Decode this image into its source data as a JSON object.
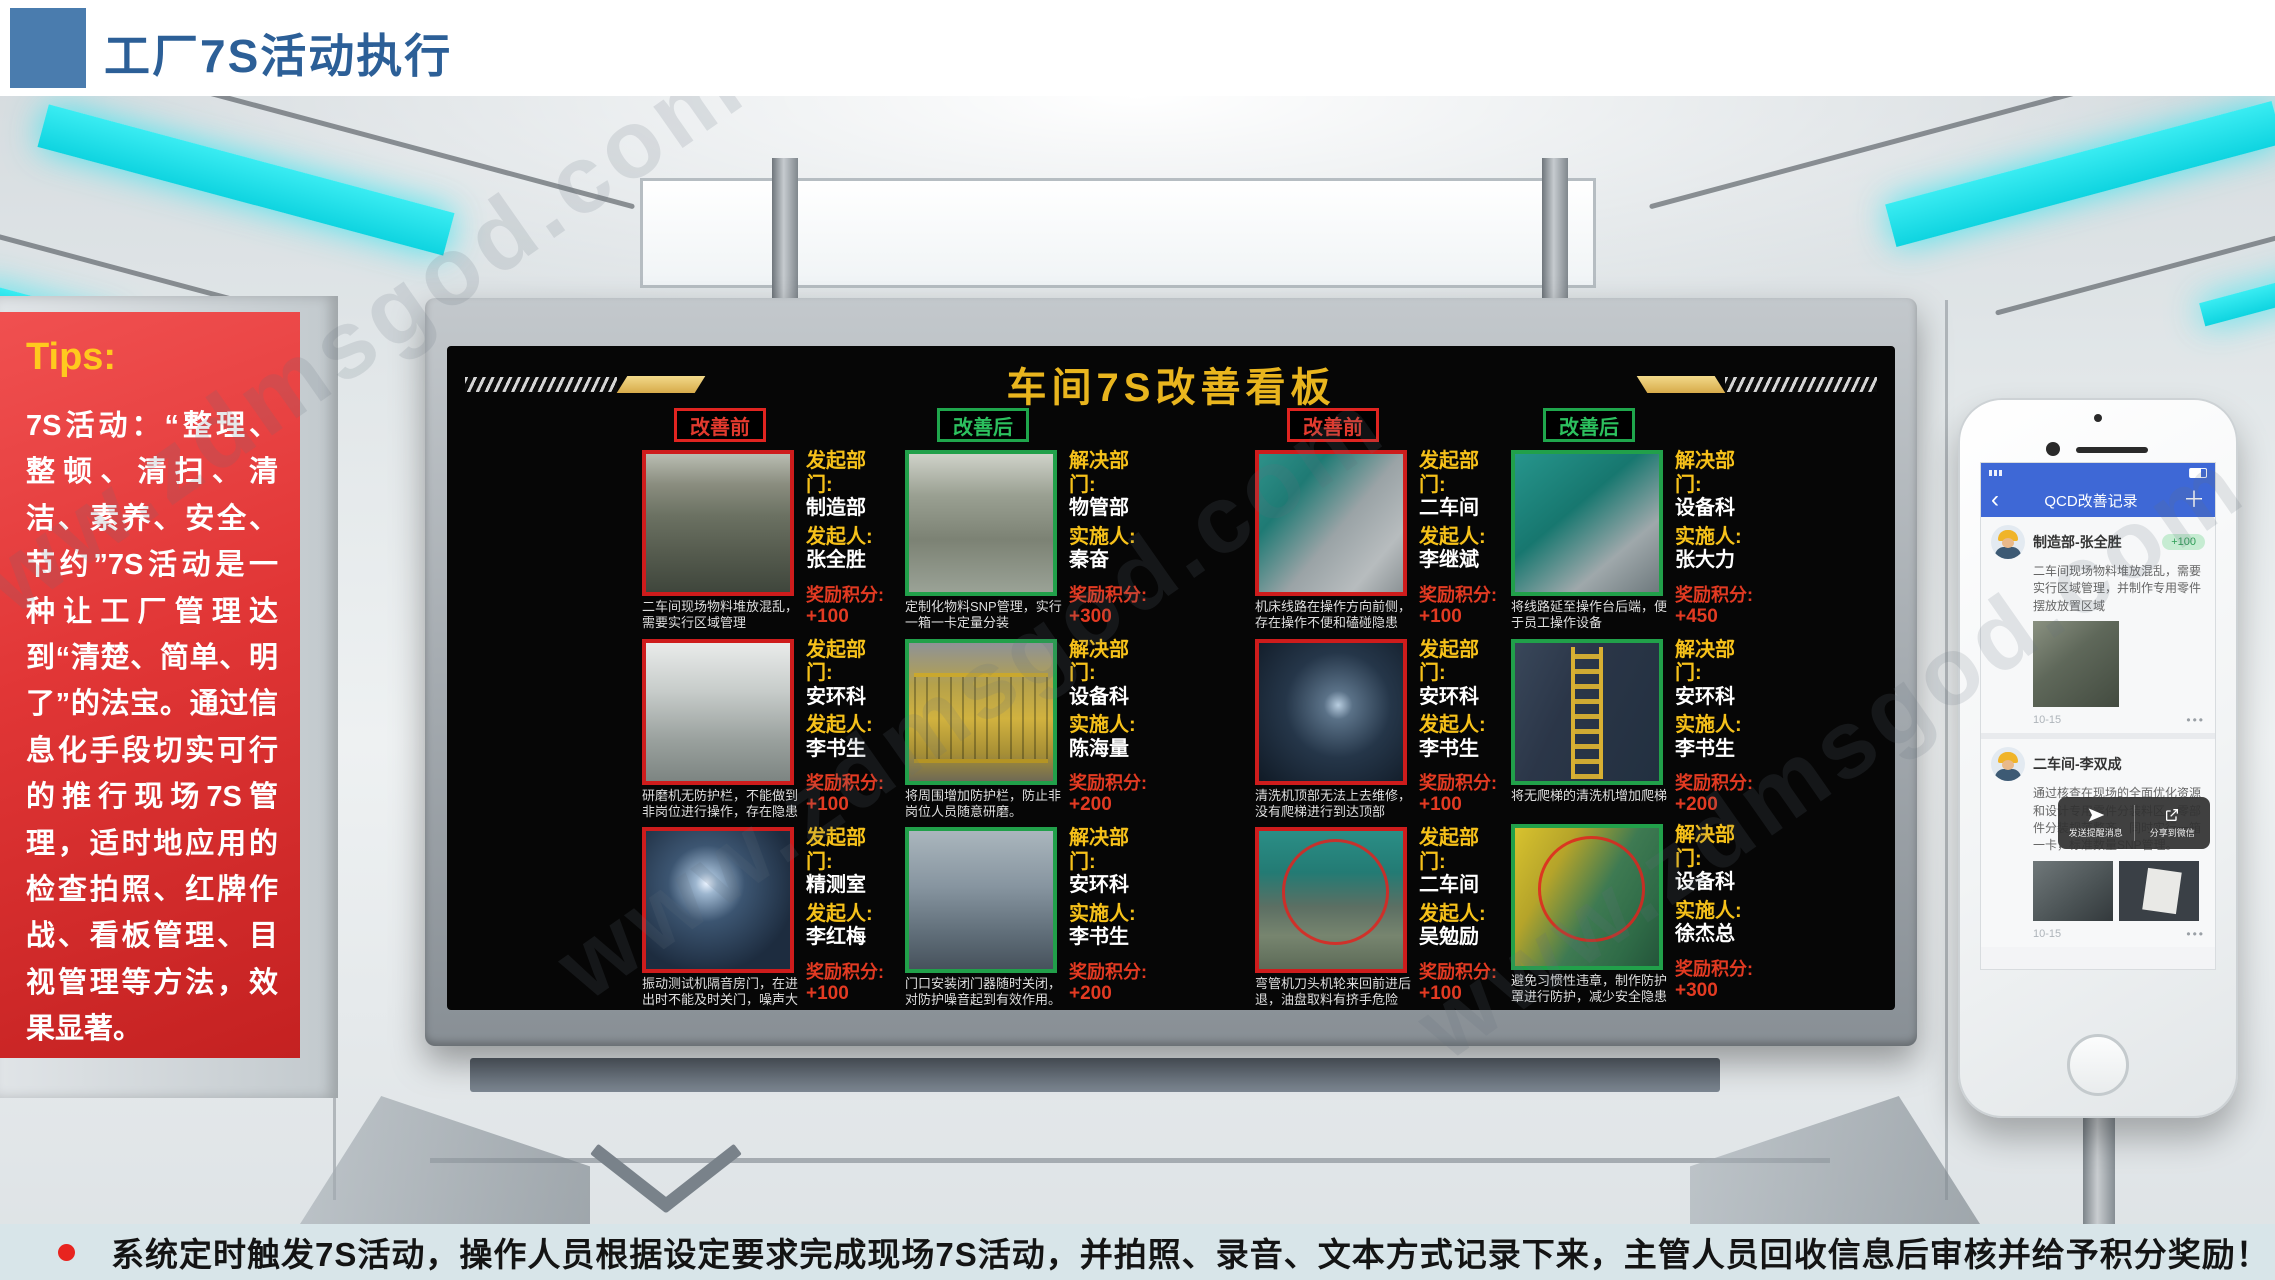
{
  "header": {
    "title": "工厂7S活动执行"
  },
  "tips": {
    "label": "Tips:",
    "lead": "7S活动：",
    "body": "“整理、整顿、清扫、清洁、素养、安全、节约”7S活动是一种让工厂管理达到“清楚、简单、明了”的法宝。通过信息化手段切实可行的推行现场7S管理，适时地应用的检查拍照、红牌作战、看板管理、目视管理等方法，效果显著。"
  },
  "board": {
    "title": "车间7S改善看板",
    "columns": [
      {
        "badge": "改善前",
        "entries": [
          {
            "dept_label": "发起部门:",
            "dept": "制造部",
            "person_label": "发起人:",
            "person": "张全胜",
            "points_label": "奖励积分:",
            "points": "+100",
            "caption": "二车间现场物料堆放混乱，需要实行区域管理"
          },
          {
            "dept_label": "发起部门:",
            "dept": "安环科",
            "person_label": "发起人:",
            "person": "李书生",
            "points_label": "奖励积分:",
            "points": "+100",
            "caption": "研磨机无防护栏，不能做到非岗位进行操作，存在隐患"
          },
          {
            "dept_label": "发起部门:",
            "dept": "精测室",
            "person_label": "发起人:",
            "person": "李红梅",
            "points_label": "奖励积分:",
            "points": "+100",
            "caption": "振动测试机隔音房门，在进出时不能及时关门，噪声大"
          }
        ]
      },
      {
        "badge": "改善后",
        "entries": [
          {
            "dept_label": "解决部门:",
            "dept": "物管部",
            "person_label": "实施人:",
            "person": "秦奋",
            "points_label": "奖励积分:",
            "points": "+300",
            "caption": "定制化物料SNP管理，实行一箱一卡定量分装"
          },
          {
            "dept_label": "解决部门:",
            "dept": "设备科",
            "person_label": "实施人:",
            "person": "陈海量",
            "points_label": "奖励积分:",
            "points": "+200",
            "caption": "将周围增加防护栏，防止非岗位人员随意研磨。"
          },
          {
            "dept_label": "解决部门:",
            "dept": "安环科",
            "person_label": "实施人:",
            "person": "李书生",
            "points_label": "奖励积分:",
            "points": "+200",
            "caption": "门口安装闭门器随时关闭，对防护噪音起到有效作用。"
          }
        ]
      },
      {
        "badge": "改善前",
        "entries": [
          {
            "dept_label": "发起部门:",
            "dept": "二车间",
            "person_label": "发起人:",
            "person": "李继斌",
            "points_label": "奖励积分:",
            "points": "+100",
            "caption": "机床线路在操作方向前侧，存在操作不便和磕碰隐患"
          },
          {
            "dept_label": "发起部门:",
            "dept": "安环科",
            "person_label": "发起人:",
            "person": "李书生",
            "points_label": "奖励积分:",
            "points": "+100",
            "caption": "清洗机顶部无法上去维修，没有爬梯进行到达顶部"
          },
          {
            "dept_label": "发起部门:",
            "dept": "二车间",
            "person_label": "发起人:",
            "person": "吴勉励",
            "points_label": "奖励积分:",
            "points": "+100",
            "caption": "弯管机刀头机轮来回前进后退，油盘取料有挤手危险"
          }
        ]
      },
      {
        "badge": "改善后",
        "entries": [
          {
            "dept_label": "解决部门:",
            "dept": "设备科",
            "person_label": "实施人:",
            "person": "张大力",
            "points_label": "奖励积分:",
            "points": "+450",
            "caption": "将线路延至操作台后端，便于员工操作设备"
          },
          {
            "dept_label": "解决部门:",
            "dept": "安环科",
            "person_label": "实施人:",
            "person": "李书生",
            "points_label": "奖励积分:",
            "points": "+200",
            "caption": "将无爬梯的清洗机增加爬梯"
          },
          {
            "dept_label": "解决部门:",
            "dept": "设备科",
            "person_label": "实施人:",
            "person": "徐杰总",
            "points_label": "奖励积分:",
            "points": "+300",
            "caption": "避免习惯性违章，制作防护罩进行防护，减少安全隐患"
          }
        ]
      }
    ]
  },
  "phone": {
    "nav": {
      "back": "‹",
      "title": "QCD改善记录",
      "add": "＋"
    },
    "posts": [
      {
        "name": "制造部-张全胜",
        "badge": "+100",
        "body": "二车间现场物料堆放混乱，需要实行区域管理，并制作专用零件摆放放置区域",
        "time": "10-15",
        "more": "•••"
      },
      {
        "name": "二车间-李双成",
        "body": "通过核查在现场的全面优化资源和设计专用零件分装料区，零部件分装规范整齐，同时实行一箱一卡，标准数量SNP管理。",
        "time": "10-15",
        "more": "•••"
      }
    ],
    "popup": {
      "send_label": "发送提醒消息",
      "share_label": "分享到微信"
    }
  },
  "footer": {
    "text": "系统定时触发7S活动，操作人员根据设定要求完成现场7S活动，并拍照、录音、文本方式记录下来，主管人员回收信息后审核并给予积分奖励！"
  },
  "watermark": {
    "text": "www.zdmsgod.com"
  }
}
